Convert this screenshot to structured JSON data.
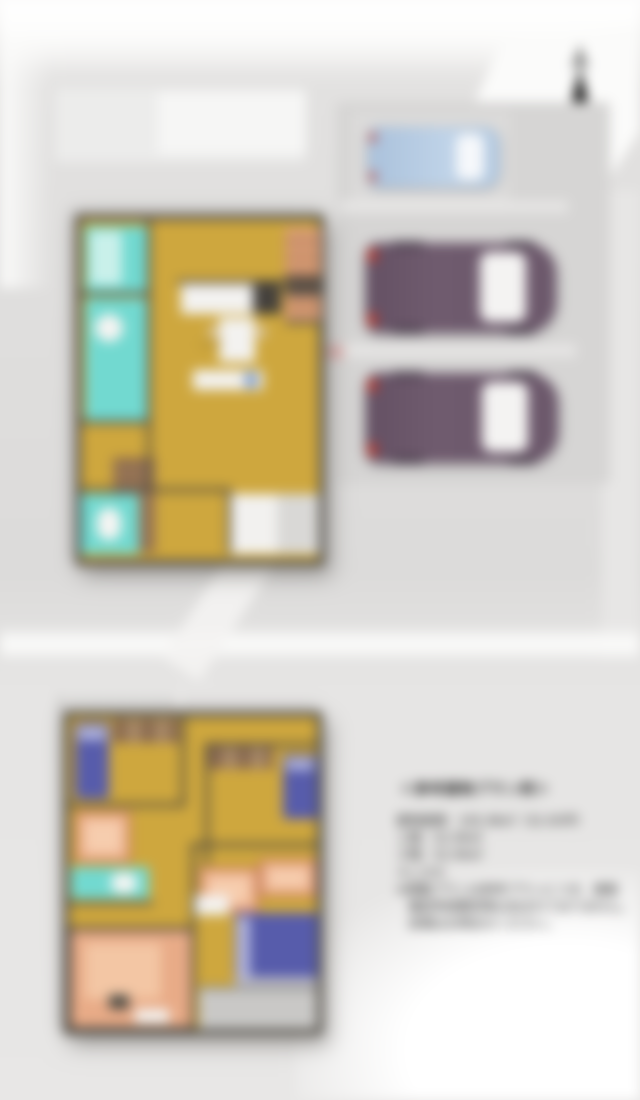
{
  "page": {
    "description": "Blurred aerial 3D floor plan rendering of a two-story house with parking lot, two purple cars, one light blue car, a north compass arrow, and a Japanese reference-plan text panel"
  },
  "compass": {
    "icon": "north-arrow"
  },
  "floor1": {
    "ldk_label": "LDK"
  },
  "info_panel": {
    "title": "＜参考建物プラン例＞",
    "lines": [
      "建物面積：105.98㎡（32.05坪）",
      "１階：52.99㎡",
      "２階：52.99㎡",
      "４ＬＤＫ",
      "※掲載プランは参考プランにつき、建築",
      "　確認申請費用等は含まれておりません。",
      "　詳細はお問合せください。"
    ]
  },
  "colors": {
    "floor_yellow": "#cea73e",
    "bath_teal": "#72d9d0",
    "bed_blue": "#575cab",
    "rug_salmon": "#efb491",
    "closet_brown": "#8a6a50",
    "car_purple": "#6c586b",
    "car_light_blue": "#b7cce3",
    "tail_light_red": "#c23b2e",
    "wall_dark": "#4a463f",
    "ground_gray": "#dcdbda"
  }
}
